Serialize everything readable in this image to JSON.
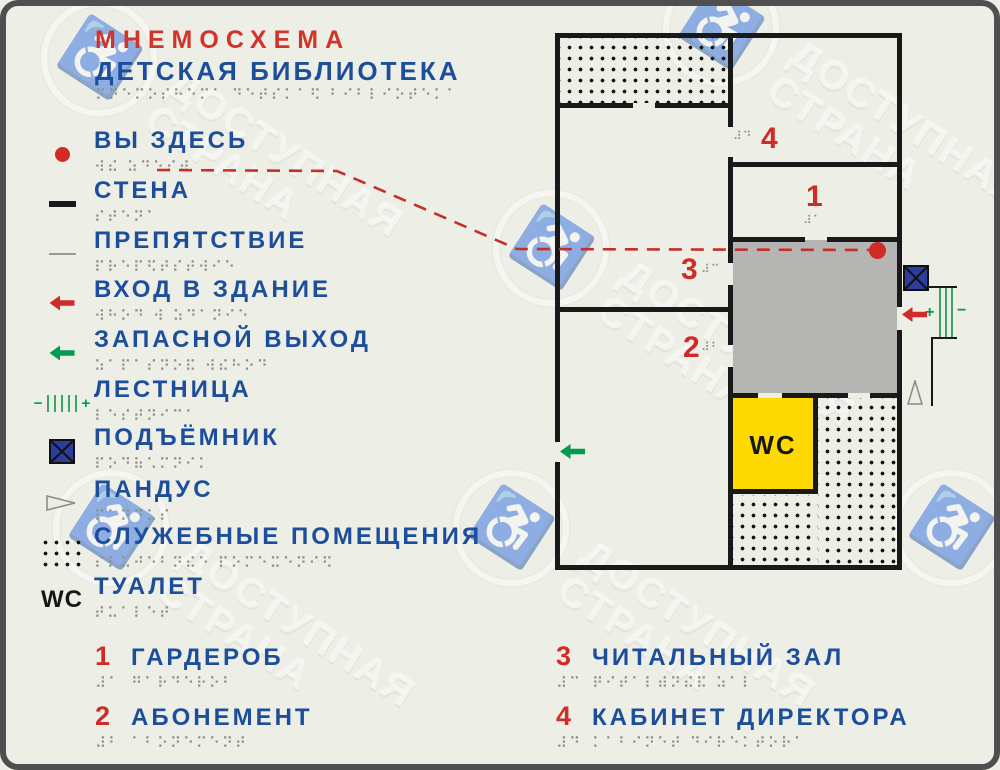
{
  "title": {
    "line1": "МНЕМОСХЕМА",
    "line2": "ДЕТСКАЯ БИБЛИОТЕКА",
    "braille": "⠍⠝⠑⠍⠕⠎⠓⠑⠍⠁ ⠙⠑⠞⠎⠅⠁⠫ ⠃⠊⠃⠇⠊⠕⠞⠑⠅⠁"
  },
  "colors": {
    "background": "#edefe6",
    "wall_black": "#191919",
    "text_blue": "#1d4e9b",
    "accent_red": "#d02b27",
    "green": "#009b4e",
    "lift_blue": "#2c3d9d",
    "wc_yellow": "#fed900",
    "hall_gray": "#b5b5b4",
    "braille_gray": "#8e8e85"
  },
  "legend": {
    "items": [
      {
        "icon": "you-are-here-dot",
        "label": "ВЫ ЗДЕСЬ",
        "braille": "⠺⠮ ⠵⠙⠑⠎⠾"
      },
      {
        "icon": "wall-line",
        "label": "СТЕНА",
        "braille": "⠎⠞⠑⠝⠁"
      },
      {
        "icon": "obstacle-line",
        "label": "ПРЕПЯТСТВИЕ",
        "braille": "⠏⠗⠑⠏⠫⠞⠎⠞⠺⠊⠑"
      },
      {
        "icon": "entrance-arrow",
        "label": "ВХОД В ЗДАНИЕ",
        "braille": "⠺⠓⠕⠙ ⠺ ⠵⠙⠁⠝⠊⠑"
      },
      {
        "icon": "exit-arrow",
        "label": "ЗАПАСНОЙ ВЫХОД",
        "braille": "⠵⠁⠏⠁⠎⠝⠕⠯ ⠺⠮⠓⠕⠙"
      },
      {
        "icon": "stairs",
        "label": "ЛЕСТНИЦА",
        "braille": "⠇⠑⠎⠞⠝⠊⠉⠁"
      },
      {
        "icon": "lift",
        "label": "ПОДЪЁМНИК",
        "braille": "⠏⠕⠙⠷⠡⠍⠝⠊⠅"
      },
      {
        "icon": "ramp",
        "label": "ПАНДУС",
        "braille": "⠏⠁⠝⠙⠥⠎"
      },
      {
        "icon": "service-dots",
        "label": "СЛУЖЕБНЫЕ ПОМЕЩЕНИЯ",
        "braille": "⠎⠇⠥⠚⠑⠃⠝⠮⠑ ⠏⠕⠍⠑⠭⠑⠝⠊⠫"
      },
      {
        "icon": "wc-letters",
        "label": "ТУАЛЕТ",
        "braille": "⠞⠥⠁⠇⠑⠞",
        "icon_text": "WC"
      }
    ]
  },
  "rooms": [
    {
      "number": "1",
      "label": "ГАРДЕРОБ",
      "number_braille": "⠼⠁",
      "braille": "⠛⠁⠗⠙⠑⠗⠕⠃"
    },
    {
      "number": "2",
      "label": "АБОНЕМЕНТ",
      "number_braille": "⠼⠃",
      "braille": "⠁⠃⠕⠝⠑⠍⠑⠝⠞"
    },
    {
      "number": "3",
      "label": "ЧИТАЛЬНЫЙ ЗАЛ",
      "number_braille": "⠼⠉",
      "braille": "⠟⠊⠞⠁⠇⠾⠝⠮⠯ ⠵⠁⠇"
    },
    {
      "number": "4",
      "label": "КАБИНЕТ ДИРЕКТОРА",
      "number_braille": "⠼⠙",
      "braille": "⠅⠁⠃⠊⠝⠑⠞ ⠙⠊⠗⠑⠅⠞⠕⠗⠁"
    }
  ],
  "plan": {
    "wc_label": "WC",
    "markers": [
      {
        "number": "4",
        "braille": "⠼⠙"
      },
      {
        "number": "1",
        "braille": "⠼⠁"
      },
      {
        "number": "3",
        "braille": "⠼⠉"
      },
      {
        "number": "2",
        "braille": "⠼⠃"
      }
    ]
  },
  "symbols": {
    "plus": "+",
    "minus": "−",
    "wheelchair": "♿"
  },
  "watermark": {
    "line1": "ДОСТУПНАЯ",
    "line2": "СТРАНА"
  }
}
